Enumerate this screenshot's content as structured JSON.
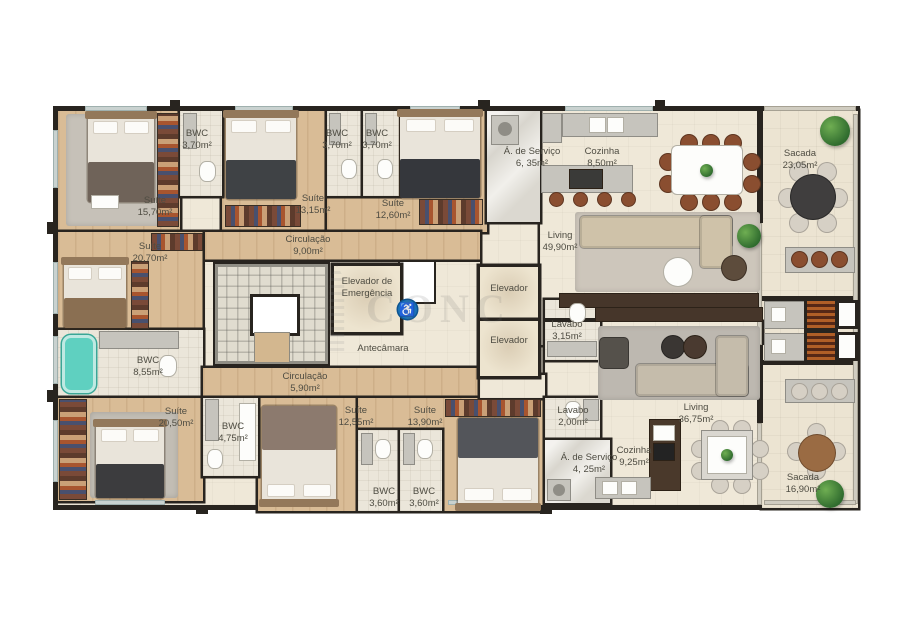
{
  "palette": {
    "wall": "#28241f",
    "wood_floor": "#d9bc96",
    "light_floor": "#efe8d8",
    "tub_teal": "#5fd0c0",
    "plant_green": "#4e8f3e",
    "accessibility_blue": "#1a72b8",
    "brick_grill": "#7b3a20"
  },
  "watermark": {
    "text": "CONC"
  },
  "core": {
    "emergency_elevator": "Elevador de Emergência",
    "anteroom": "Antecâmara",
    "elevator_1": "Elevador",
    "elevator_2": "Elevador"
  },
  "apartment_a": {
    "suite_1570": {
      "name": "Suíte",
      "area": "15,70m²"
    },
    "bwc_370a": {
      "name": "BWC",
      "area": "3,70m²"
    },
    "suite_1315": {
      "name": "Suíte",
      "area": "13,15m²"
    },
    "bwc_370b": {
      "name": "BWC",
      "area": "3,70m²"
    },
    "bwc_370c": {
      "name": "BWC",
      "area": "3,70m²"
    },
    "suite_1260": {
      "name": "Suíte",
      "area": "12,60m²"
    },
    "servico_635": {
      "name": "Á. de Serviço",
      "area": "6, 35m²"
    },
    "cozinha_850": {
      "name": "Cozinha",
      "area": "8,50m²"
    },
    "living_4990": {
      "name": "Living",
      "area": "49,90m²"
    },
    "sacada_2305": {
      "name": "Sacada",
      "area": "23,05m²"
    },
    "suite_2070": {
      "name": "Suíte",
      "area": "20,70m²"
    },
    "circulacao_900": {
      "name": "Circulação",
      "area": "9,00m²"
    },
    "lavabo_315": {
      "name": "Lavabo",
      "area": "3,15m²"
    }
  },
  "apartment_b": {
    "bwc_855": {
      "name": "BWC",
      "area": "8,55m²"
    },
    "suite_2050": {
      "name": "Suíte",
      "area": "20,50m²"
    },
    "bwc_475": {
      "name": "BWC",
      "area": "4,75m²"
    },
    "circulacao_590": {
      "name": "Circulação",
      "area": "5,90m²"
    },
    "suite_1255": {
      "name": "Suíte",
      "area": "12,55m²"
    },
    "suite_1390": {
      "name": "Suíte",
      "area": "13,90m²"
    },
    "bwc_360a": {
      "name": "BWC",
      "area": "3,60m²"
    },
    "bwc_360b": {
      "name": "BWC",
      "area": "3,60m²"
    },
    "lavabo_200": {
      "name": "Lavabo",
      "area": "2,00m²"
    },
    "servico_425": {
      "name": "Á. de Serviço",
      "area": "4, 25m²"
    },
    "cozinha_925": {
      "name": "Cozinha",
      "area": "9,25m²"
    },
    "living_3675": {
      "name": "Living",
      "area": "36,75m²"
    },
    "sacada_1690": {
      "name": "Sacada",
      "area": "16,90m²"
    }
  }
}
